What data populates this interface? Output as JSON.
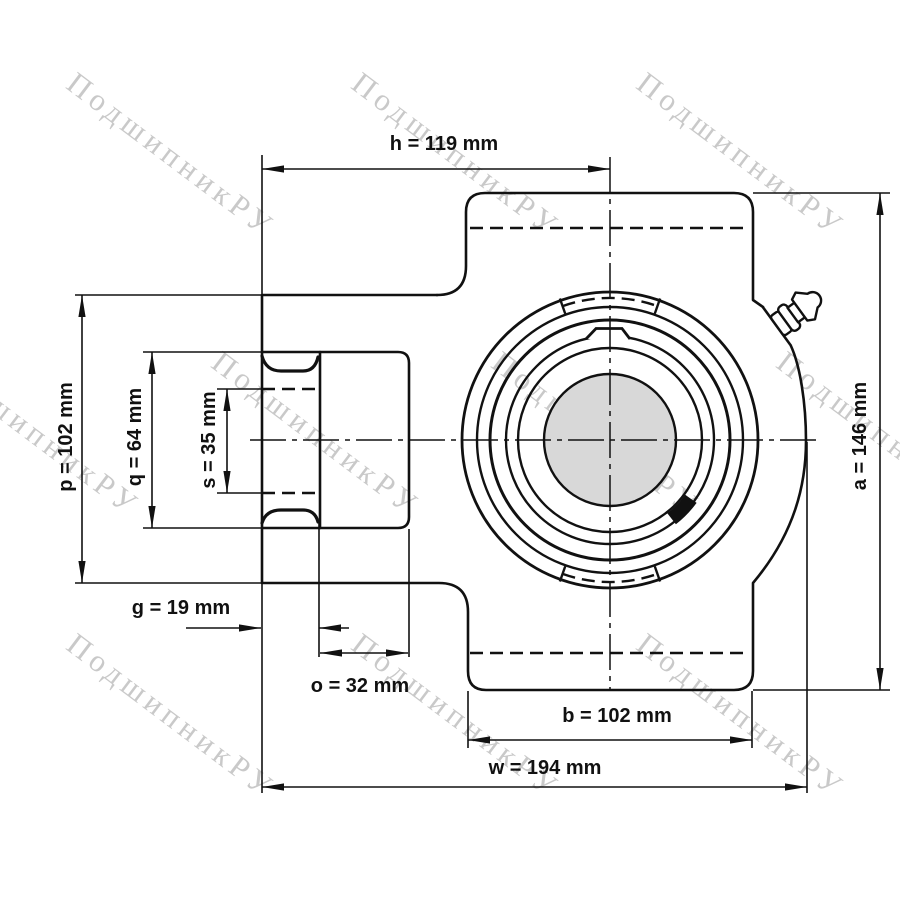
{
  "drawing": {
    "type": "bearing take-up unit dimension drawing",
    "watermark": {
      "text": "ПодшипникРУ"
    },
    "dimensions": {
      "h": "h = 119 mm",
      "p": "p = 102 mm",
      "q": "q = 64 mm",
      "s": "s = 35 mm",
      "g": "g = 19 mm",
      "o": "o = 32 mm",
      "b": "b = 102 mm",
      "w": "w = 194 mm",
      "a": "a = 146 mm"
    },
    "dimension_values": [
      {
        "name": "h",
        "value_mm": 119
      },
      {
        "name": "p",
        "value_mm": 102
      },
      {
        "name": "q",
        "value_mm": 64
      },
      {
        "name": "s",
        "value_mm": 35
      },
      {
        "name": "g",
        "value_mm": 19
      },
      {
        "name": "o",
        "value_mm": 32
      },
      {
        "name": "b",
        "value_mm": 102
      },
      {
        "name": "w",
        "value_mm": 194
      },
      {
        "name": "a",
        "value_mm": 146
      }
    ],
    "colors": {
      "line": "#111111",
      "bore_fill": "#d8d8d8",
      "watermark": "#c9c9c9",
      "background": "#ffffff"
    }
  }
}
